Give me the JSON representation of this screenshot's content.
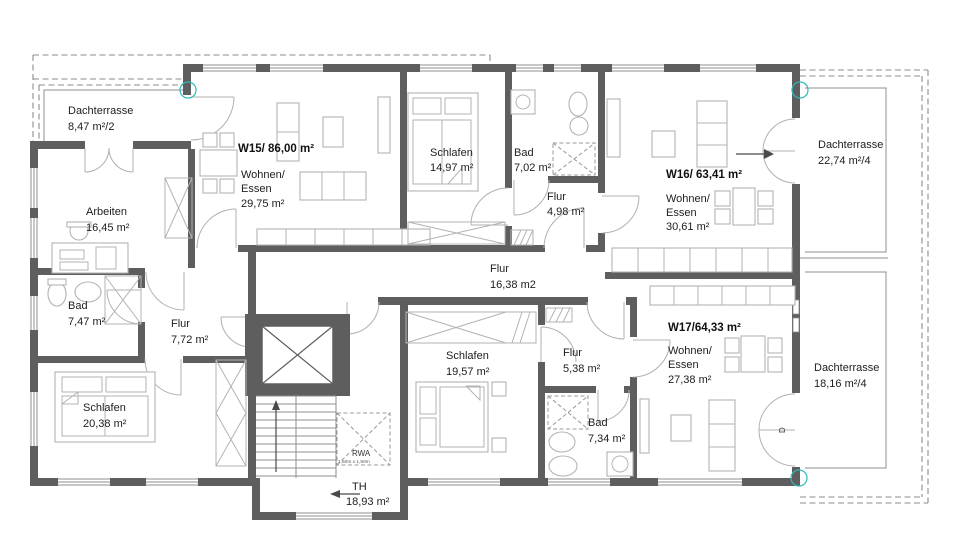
{
  "apartments": {
    "w15": {
      "title": "W15/ 86,00 m²",
      "wohnen": "Wohnen/",
      "essen": "Essen",
      "area": "29,75 m²"
    },
    "w16": {
      "title": "W16/ 63,41 m²",
      "wohnen": "Wohnen/",
      "essen": "Essen",
      "area": "30,61 m²"
    },
    "w17": {
      "title": "W17/64,33 m²",
      "wohnen": "Wohnen/",
      "essen": "Essen",
      "area": "27,38 m²"
    }
  },
  "rooms": {
    "dachterrasse_nw": {
      "name": "Dachterrasse",
      "area": "8,47 m²/2"
    },
    "dachterrasse_ne": {
      "name": "Dachterrasse",
      "area": "22,74 m²/4"
    },
    "dachterrasse_se": {
      "name": "Dachterrasse",
      "area": "18,16 m²/4"
    },
    "arbeiten": {
      "name": "Arbeiten",
      "area": "16,45 m²"
    },
    "bad_w15": {
      "name": "Bad",
      "area": "7,47 m²"
    },
    "flur_w15": {
      "name": "Flur",
      "area": "7,72 m²"
    },
    "schlafen_w15": {
      "name": "Schlafen",
      "area": "20,38 m²"
    },
    "schlafen_w16": {
      "name": "Schlafen",
      "area": "14,97 m²"
    },
    "bad_w16": {
      "name": "Bad",
      "area": "7,02 m²"
    },
    "flur_w16": {
      "name": "Flur",
      "area": "4,98 m²"
    },
    "flur_shared": {
      "name": "Flur",
      "area": "16,38 m2"
    },
    "schlafen_w17": {
      "name": "Schlafen",
      "area": "19,57 m²"
    },
    "flur_w17": {
      "name": "Flur",
      "area": "5,38 m²"
    },
    "bad_w17": {
      "name": "Bad",
      "area": "7,34 m²"
    },
    "treppenhaus": {
      "name": "TH",
      "area": "18,93 m²"
    }
  },
  "annotations": {
    "rwa_label": "RWA",
    "rwa_size": "1,50m x 1,50m",
    "door_marker": "D"
  },
  "colors": {
    "wall": "#5e5e5e",
    "line": "#8f8f8f",
    "furniture": "#b3b3b3",
    "accent_teal": "#2db9b9",
    "text": "#1d1d1d"
  }
}
